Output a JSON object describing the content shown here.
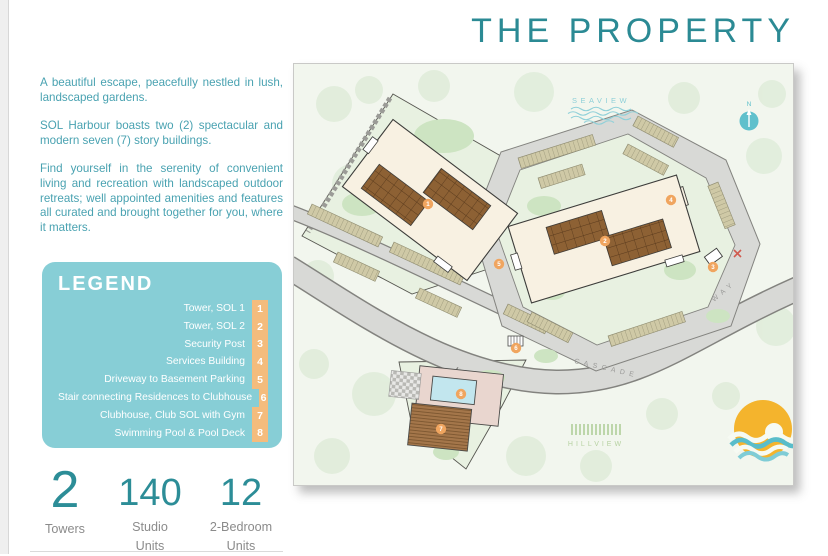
{
  "page": {
    "title": "THE PROPERTY"
  },
  "intro": {
    "paragraphs": [
      "A beautiful escape, peacefully nestled in lush, landscaped gardens.",
      "SOL Harbour boasts two (2) spectacular and modern seven (7) story buildings.",
      "Find yourself in the serenity of convenient living and recreation with landscaped outdoor retreats; well appointed amenities and features all curated and brought together for you, where it matters."
    ]
  },
  "legend": {
    "title": "LEGEND",
    "items": [
      {
        "number": "1",
        "label": "Tower, SOL 1"
      },
      {
        "number": "2",
        "label": "Tower, SOL 2"
      },
      {
        "number": "3",
        "label": "Security Post"
      },
      {
        "number": "4",
        "label": "Services Building"
      },
      {
        "number": "5",
        "label": "Driveway to Basement Parking"
      },
      {
        "number": "6",
        "label": "Stair connecting Residences to Clubhouse"
      },
      {
        "number": "7",
        "label": "Clubhouse, Club SOL with Gym"
      },
      {
        "number": "8",
        "label": "Swimming Pool & Pool Deck"
      }
    ]
  },
  "stats": [
    {
      "value": "2",
      "label_line1": "",
      "label_line2": "Towers"
    },
    {
      "value": "140",
      "label_line1": "Studio",
      "label_line2": "Units"
    },
    {
      "value": "12",
      "label_line1": "2-Bedroom",
      "label_line2": "Units"
    }
  ],
  "map": {
    "labels": {
      "seaview": "SEAVIEW",
      "hillview": "HILLVIEW",
      "road_name_1": "CASCADE",
      "road_name_2": "WAY",
      "compass_north": "N"
    }
  },
  "colors": {
    "title_teal": "#2b8a94",
    "body_teal": "#49a2b1",
    "legend_background": "#87ced6",
    "legend_number_orange": "#f4bc7d",
    "marker_orange": "#f0a55f",
    "stat_number_teal": "#2c8d97",
    "logo_sun_yellow": "#f4b42d",
    "logo_wave_teal": "#59bdca"
  }
}
